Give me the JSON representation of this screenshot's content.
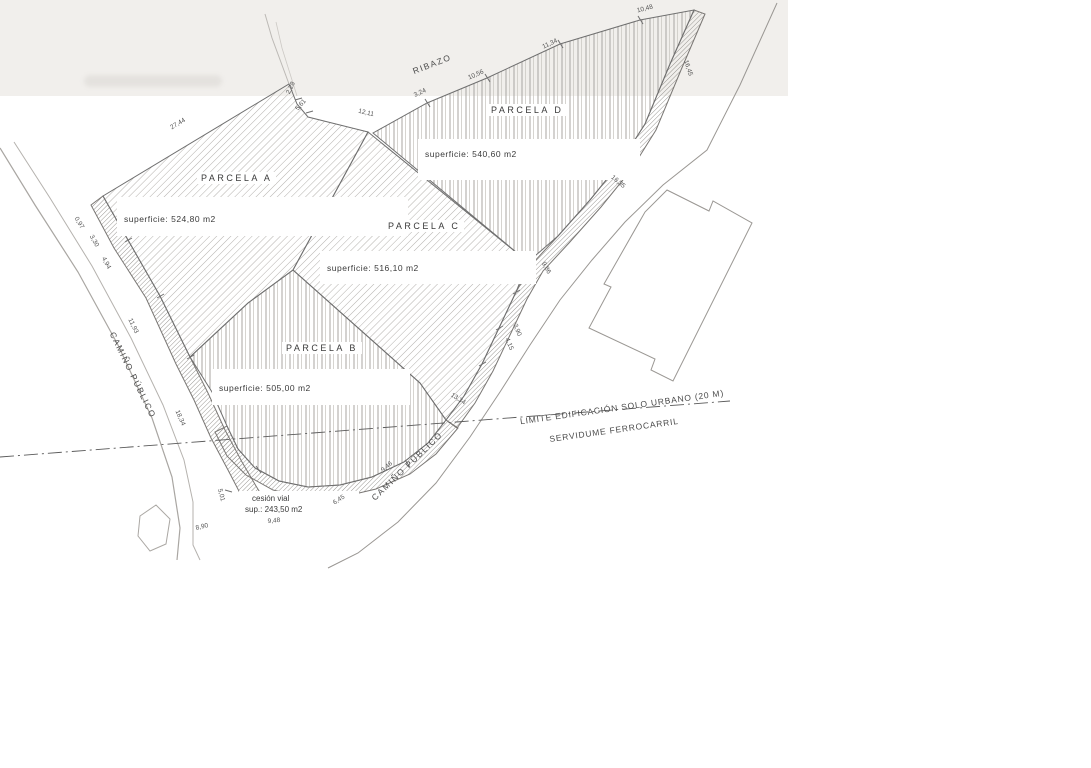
{
  "parcels": [
    {
      "label": "PARCELA A",
      "area": "superficie: 524,80 m2"
    },
    {
      "label": "PARCELA B",
      "area": "superficie: 505,00 m2"
    },
    {
      "label": "PARCELA C",
      "area": "superficie: 516,10 m2"
    },
    {
      "label": "PARCELA D",
      "area": "superficie: 540,60 m2"
    }
  ],
  "cession": {
    "line1": "cesión vial",
    "line2": "sup.:  243,50  m2"
  },
  "roads": {
    "left": "CAMIÑO PÚBLICO",
    "bottom_right": "CAMIÑO PÚBLICO",
    "top_edge": "RIBAZO"
  },
  "limit": {
    "line1": "LIMITE EDIFICACIÓN SOLO URBANO (20 M)",
    "line2": "SERVIDUME FERROCARRIL"
  },
  "dimensions": [
    "27,44",
    "2,28",
    "5,61",
    "12,11",
    "3,24",
    "10,56",
    "11,34",
    "10,48",
    "16,45",
    "16,35",
    "9,86",
    "3,90",
    "4,15",
    "13,34",
    "9,46",
    "6,45",
    "9,48",
    "8,90",
    "5,01",
    "18,34",
    "11,93",
    "4,94",
    "3,30",
    "0,97"
  ],
  "colors": {
    "line": "#6f6f6f",
    "hatch": "#b3b0ac",
    "band": "#f1efec",
    "text": "#3a3a3a"
  }
}
